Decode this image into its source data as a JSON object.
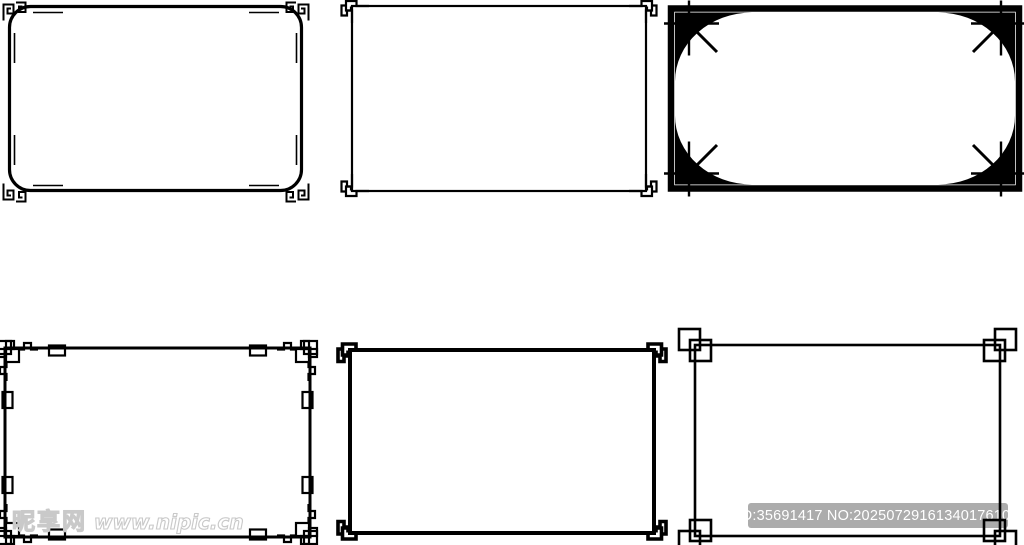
{
  "meta": {
    "background": "#ffffff",
    "ink": "#000000"
  },
  "watermarks": {
    "site": {
      "cn": "昵享网",
      "url": "www.nipic.cn",
      "color": "#c9c9c9"
    },
    "id_bar": {
      "text": "ID:35691417 NO:20250729161340176106",
      "bg": "#a8a8a8",
      "fg": "#ffffff"
    }
  },
  "frames": [
    {
      "name": "rounded-frame-with-greek-spiral-corners",
      "row": 1,
      "col": 1
    },
    {
      "name": "thin-frame-with-meander-hook-corners",
      "row": 1,
      "col": 2
    },
    {
      "name": "art-deco-frame-with-oval-cutout",
      "row": 1,
      "col": 3
    },
    {
      "name": "frame-with-lattice-fret-corners",
      "row": 2,
      "col": 1
    },
    {
      "name": "bold-frame-with-meander-hook-corners",
      "row": 2,
      "col": 2
    },
    {
      "name": "frame-with-hash-square-corners",
      "row": 2,
      "col": 3
    }
  ]
}
